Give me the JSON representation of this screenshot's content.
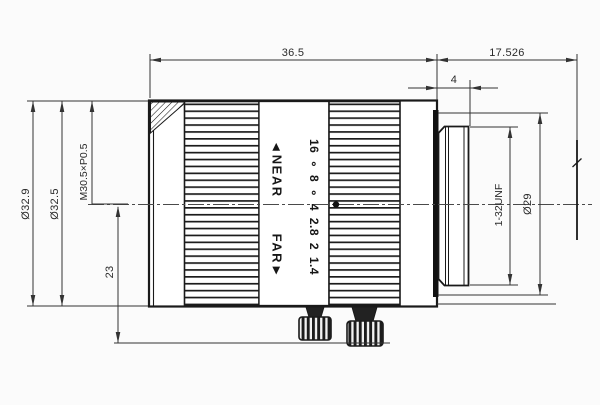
{
  "drawing": {
    "title": "lens-outline-technical-drawing",
    "background": "#fbfbfb",
    "line_color": "#1a1a1a",
    "dimension_color": "#333333",
    "dimensions": {
      "body_length": "36.5",
      "flange_focal_distance": "17.526",
      "thread_length": "4",
      "front_diameter": "Ø32.9",
      "body_diameter": "Ø32.5",
      "filter_thread": "M30.5×P0.5",
      "axis_to_bottom": "23",
      "mount_diameter": "Ø29",
      "mount_thread": "1-32UNF"
    },
    "markings": {
      "near_label": "◄NEAR",
      "far_label": "FAR►",
      "aperture_scale": "16 ∘ 8 ∘ 4  2.8  2  1.4"
    }
  }
}
